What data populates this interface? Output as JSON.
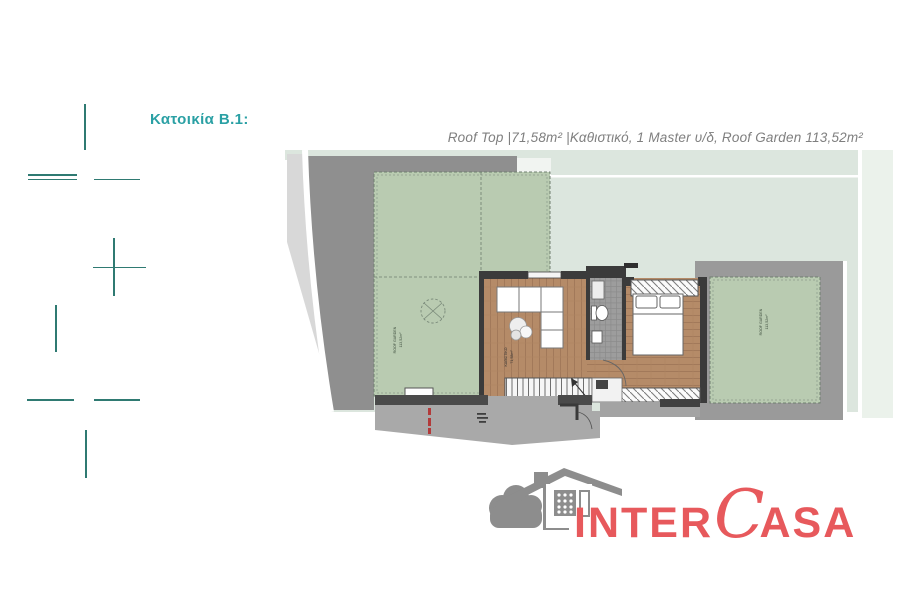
{
  "title": {
    "text": "Κατοικία B.1:"
  },
  "header": {
    "text": "Roof Top  |71,58m² |Καθιστικό, 1 Master υ/δ, Roof Garden 113,52m²"
  },
  "plan": {
    "labels": {
      "garden_left_line1": "ROOF GARDEN",
      "garden_left_line2": "113,52m²",
      "living_line1": "ΚΑΘΙΣΤΙΚΟ",
      "living_line2": "71,58m²",
      "garden_right_line1": "ROOF GARDEN",
      "garden_right_line2": "113,52m²"
    }
  },
  "logo": {
    "part1": "INTER",
    "part2": "C",
    "part3": "ASA"
  },
  "colors": {
    "title_teal": "#2aa0a4",
    "crop_mark_teal": "#2f7a72",
    "header_gray": "#7f7f7f",
    "logo_red": "#e7595c",
    "logo_gray": "#8d8d8d",
    "pale_green": "#dce6de",
    "garden_green": "#b9cbb1",
    "road_gray": "#8f8f8f",
    "wall_dark": "#3b3b3b",
    "wood_brown": "#b58b68",
    "terrace_gray": "#a9a9a9"
  }
}
